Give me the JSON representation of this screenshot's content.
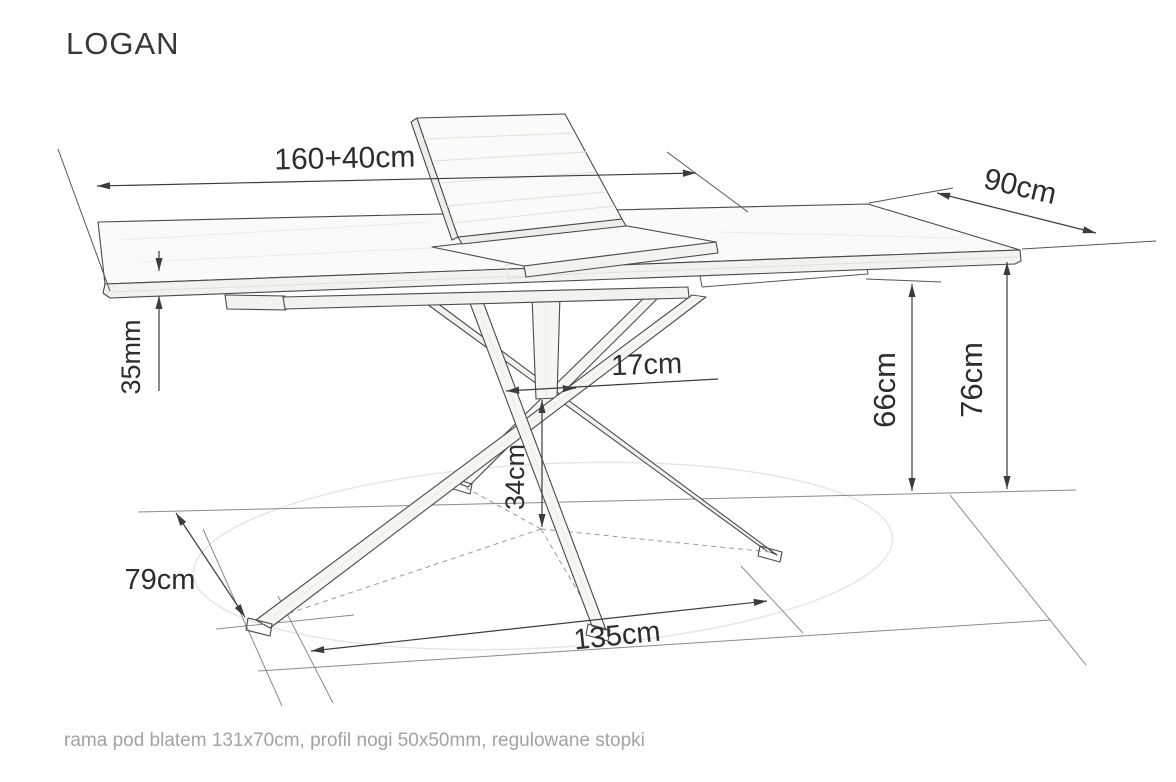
{
  "title": "LOGAN",
  "dimensions": {
    "table_length": "160+40cm",
    "table_width": "90cm",
    "top_thickness": "35mm",
    "column_width": "17cm",
    "underframe_height": "66cm",
    "table_height": "76cm",
    "base_cross_height": "34cm",
    "base_depth": "79cm",
    "base_length": "135cm"
  },
  "footer_note": "rama pod blatem 131x70cm, profil nogi 50x50mm, regulowane stopki"
}
